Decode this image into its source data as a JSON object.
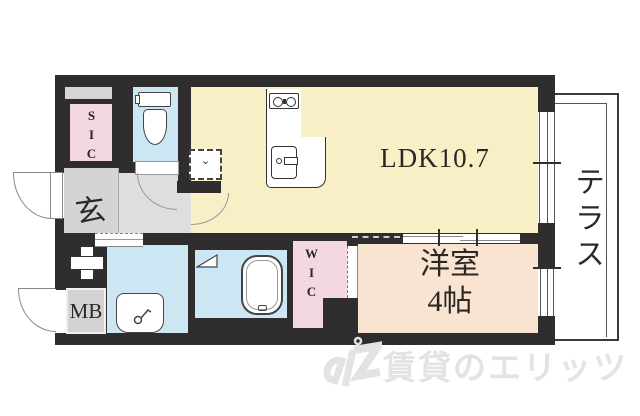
{
  "plan_type": "apartment-floor-plan",
  "rooms": {
    "ldk": {
      "label": "LDK10.7"
    },
    "western_room": {
      "line1": "洋室",
      "line2": "4帖"
    },
    "terrace": {
      "label": "テラス"
    },
    "sic": {
      "label": "SIC"
    },
    "wic": {
      "label": "WIC"
    },
    "entrance": {
      "label": "玄"
    },
    "meter_box": {
      "label": "MB"
    }
  },
  "icons": {
    "appliance_mark": "⌄",
    "names": [
      "toilet-icon",
      "stove-icon",
      "kitchen-sink-icon",
      "washbasin-icon",
      "bathtub-icon",
      "folding-door-icon",
      "pipe-shaft-icon",
      "appliance-space-icon",
      "door-swing-arc",
      "window-icon",
      "sliding-door-icon",
      "elitz-logo-icon"
    ]
  },
  "watermark": {
    "text": "賃貸のエリッツ"
  },
  "colors": {
    "wall": "#2f2d2e",
    "ldk_cream": "#f9efc6",
    "western_peach": "#f9e4d2",
    "closet_pink": "#f3d7e2",
    "water_blue": "#cde6f4",
    "genkan_gray": "#d4d4d4",
    "hall_gray": "#dedede",
    "meter_gray": "#d2d2d2",
    "watermark_gray": "#e3e3e3"
  }
}
